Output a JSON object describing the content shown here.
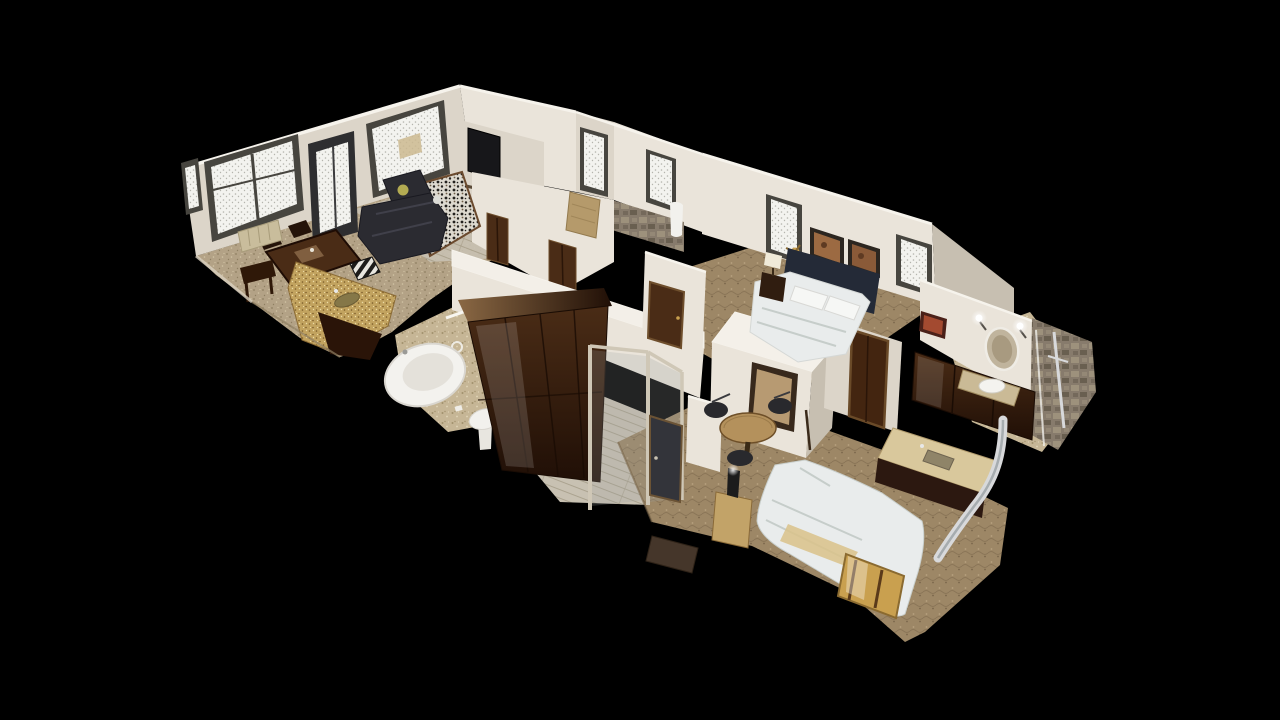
{
  "app": {
    "name": "3d-dollhouse-viewer",
    "description": "3D photogrammetry dollhouse cutaway view of a furnished one-bedroom suite, floating on a solid black background, viewed obliquely from above",
    "view_mode": "dollhouse",
    "visible_text": []
  },
  "palette": {
    "background": "#000000",
    "wallLight": "#eae4da",
    "wallMid": "#dcd5c9",
    "wallDark": "#c7bfb1",
    "wallEdge": "#f6f3ec",
    "carpetTan": "#b3a286",
    "carpetTanD": "#8f7f62",
    "carpetTanL": "#d2c4a6",
    "tile": "#c6b696",
    "tileD": "#a2916d",
    "tileL": "#e1d5b7",
    "carpetBrown": "#9d8766",
    "carpetBrownD": "#7a664a",
    "carpetBrownL": "#b8a280",
    "wood": "#c8c1b2",
    "woodLine": "#a8a08c",
    "granite": "#c2a35f",
    "graniteD": "#7c5c2a",
    "graniteL": "#ebdaa5",
    "darkWood": "#4a2c16",
    "darkWoodD": "#200f06",
    "darkWoodHi": "#8a6844",
    "sofa": "#2b2b31",
    "sofaD": "#191920",
    "sofaHi": "#40404a",
    "glass": "#f3f3ef",
    "glassSpeck": "#b5b5ae",
    "frame": "#47453f",
    "linen": "#e9ecec",
    "linenD": "#c6cdca",
    "fixture": "#f2f1ed",
    "stone": "#877b6c",
    "stoneD": "#625849",
    "stoneL": "#a29680",
    "brass": "#c9a04f",
    "chrome": "#d8d9db",
    "navy": "#242a37",
    "artWarm": "#9c6a42",
    "artWarm2": "#8a5a38",
    "doorSlate": "#33343a",
    "mat": "#45362a",
    "pillowAccent": "#b3ab52"
  },
  "scene": {
    "projection": "oblique-dollhouse",
    "cutaway": true,
    "rooms": [
      {
        "name": "living-room",
        "objects": [
          "picture-window",
          "glass-front-door",
          "picture-window-2",
          "leather-sectional-sofa",
          "accent-pillow",
          "speckled-rug",
          "wall-mounted-tv",
          "dark-wood-dining-table",
          "dining-chairs",
          "zebra-print-chairs",
          "side-table",
          "radiator",
          "granite-bar-counter",
          "bar-sink"
        ]
      },
      {
        "name": "bathroom",
        "objects": [
          "corner-soaking-tub",
          "pedestal-sink",
          "towel-bar",
          "speckled-tile-floor"
        ]
      },
      {
        "name": "hallway",
        "objects": [
          "wood-plank-floor",
          "dark-wood-armoire",
          "glass-entry-partition",
          "slate-entry-door",
          "door-mat",
          "interior-doors"
        ]
      },
      {
        "name": "master-bedroom",
        "objects": [
          "navy-headboard-bed",
          "white-linens",
          "framed-art-pair",
          "nightstand-with-lamp",
          "sparkling-windows",
          "framed-wall-mirror",
          "round-pedestal-table",
          "wrought-iron-chairs",
          "wood-panel-door",
          "hanging-robe",
          "stone-accent-wall",
          "wicker-chair"
        ]
      },
      {
        "name": "second-bedroom",
        "objects": [
          "white-bed",
          "tan-blanket",
          "gold-luggage-bench",
          "nightstand-with-dark-lamp",
          "brown-carpet"
        ]
      },
      {
        "name": "kitchenette",
        "objects": [
          "dark-wood-upper-cabinets",
          "dark-wood-lower-cabinets",
          "tan-countertop",
          "kitchen-sink",
          "chrome-vent-pipe"
        ]
      },
      {
        "name": "en-suite-bathroom",
        "objects": [
          "vanity-with-vessel-sink",
          "oval-mirror",
          "wall-sconces",
          "small-framed-art",
          "stone-tile-shower",
          "glass-shower-panel",
          "chrome-shower-bar"
        ]
      }
    ]
  }
}
